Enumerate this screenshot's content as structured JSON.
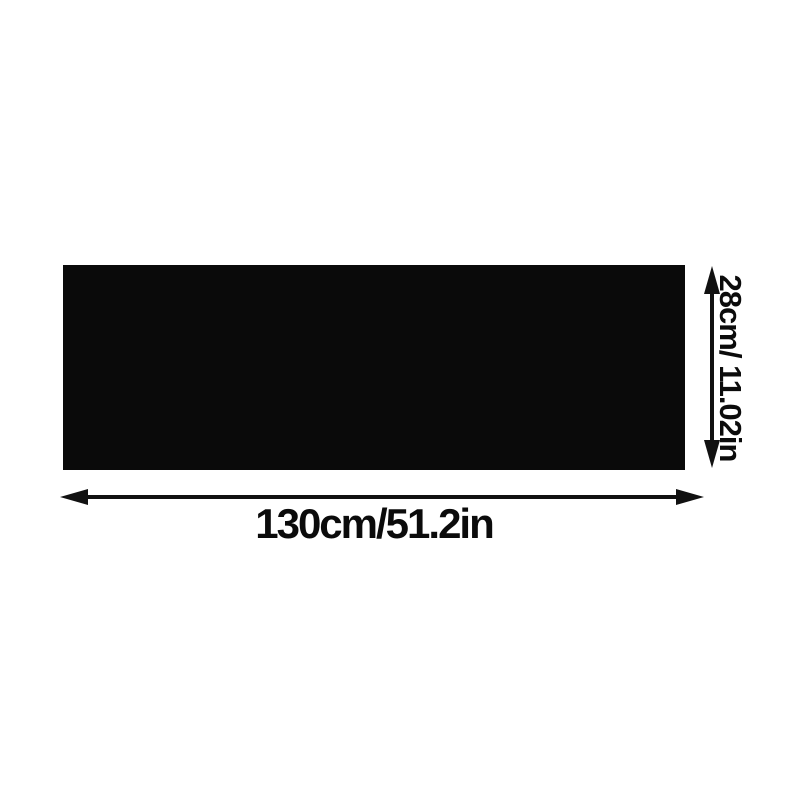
{
  "diagram": {
    "background_color": "#ffffff",
    "shape_color": "#0a0a0a",
    "arrow_color": "#111111",
    "text_color": "#0b0b0b",
    "dimensions": {
      "width_label": "130cm/51.2in",
      "height_label": "28cm/ 11.02in"
    }
  }
}
